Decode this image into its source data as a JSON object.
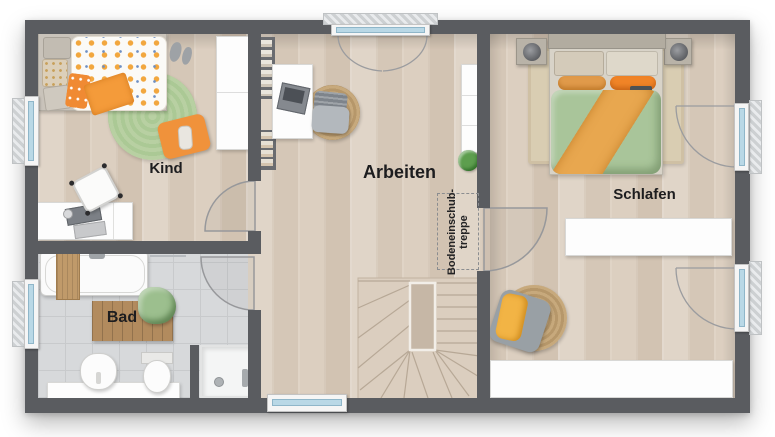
{
  "floorplan": {
    "rooms": {
      "kind": {
        "label": "Kind"
      },
      "arbeiten": {
        "label": "Arbeiten"
      },
      "schlafen": {
        "label": "Schlafen"
      },
      "bad": {
        "label": "Bad"
      },
      "attic_hatch": {
        "label_lines": [
          "Bodeneinschub-",
          "treppe"
        ]
      }
    },
    "colors": {
      "wall": "#5a5c60",
      "wood_floor": "#d9cbbb",
      "tile_floor": "#d7d9db",
      "accent_orange": "#f09a3e",
      "duvet_green": "#a9c59a",
      "rug_green": "#b3cc9b",
      "rug_jute": "#c0a274",
      "bath_mat_wood": "#b28b5e",
      "window_glass": "#b9d8e6",
      "furniture_white": "#fdfdfd"
    }
  }
}
